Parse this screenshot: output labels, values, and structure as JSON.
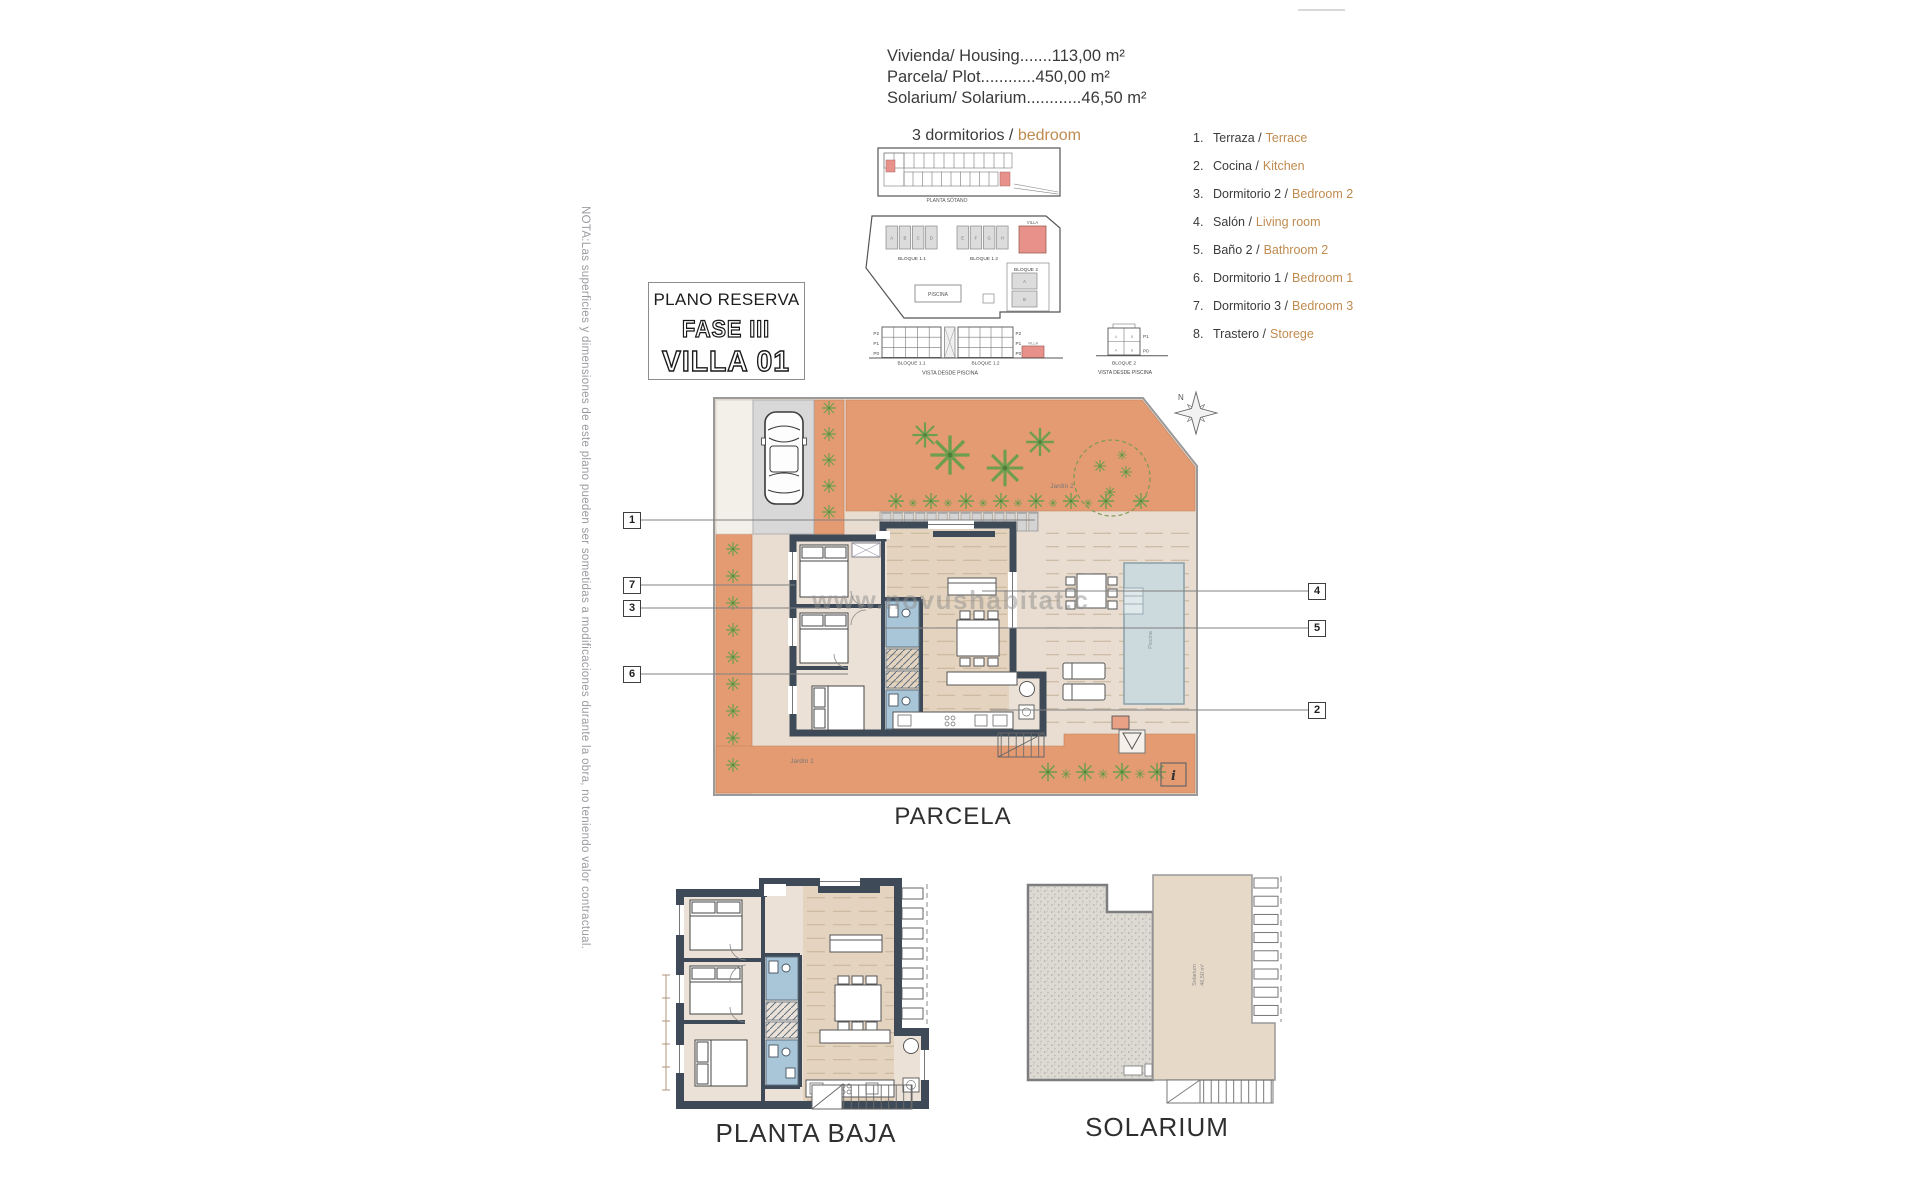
{
  "header": {
    "measurements": [
      "Vivienda/ Housing.......113,00 m²",
      "Parcela/ Plot............450,00 m²",
      "Solarium/ Solarium............46,50 m²"
    ],
    "bedrooms_es": "3 dormitorios /",
    "bedrooms_en": "bedroom"
  },
  "title_box": {
    "line1": "PLANO RESERVA",
    "line2": "FASE III",
    "line3": "VILLA 01"
  },
  "legend": {
    "items": [
      {
        "num": "1.",
        "es": "Terraza /",
        "en": "Terrace"
      },
      {
        "num": "2.",
        "es": "Cocina /",
        "en": "Kitchen"
      },
      {
        "num": "3.",
        "es": "Dormitorio 2 /",
        "en": "Bedroom 2"
      },
      {
        "num": "4.",
        "es": "Salón /",
        "en": "Living room"
      },
      {
        "num": "5.",
        "es": "Baño 2 /",
        "en": "Bathroom 2"
      },
      {
        "num": "6.",
        "es": "Dormitorio 1 /",
        "en": "Bedroom 1"
      },
      {
        "num": "7.",
        "es": "Dormitorio 3 /",
        "en": "Bedroom 3"
      },
      {
        "num": "8.",
        "es": "Trastero /",
        "en": "Storege"
      }
    ]
  },
  "note_vertical": "NOTA:Las superficies y dimensiones de este plano pueden ser sometidas a modificaciones durante la obra, no teniendo valor contractual.",
  "watermark": "www.novushabitat.c",
  "site_plans": {
    "sotano_label": "PLANTA SÓTANO",
    "bloque11": "BLOQUE 1.1",
    "bloque12": "BLOQUE 1.2",
    "bloque2": "BLOQUE 2",
    "piscina": "PISCINA",
    "villa": "VILLA",
    "vista": "VISTA DESDE PISCINA",
    "p2": "P2",
    "p1": "P1",
    "p0": "P0",
    "unit_letters_1": [
      "A",
      "B",
      "C",
      "D"
    ],
    "unit_letters_2": [
      "E",
      "F",
      "G",
      "H"
    ],
    "unit_letters_b2": [
      "A",
      "B"
    ]
  },
  "parcela": {
    "caption": "PARCELA",
    "jardin1": "Jardín 1",
    "jardin2": "Jardín 2",
    "info": "i",
    "north": "N",
    "pool_label": "Piscina"
  },
  "planta_baja": {
    "caption": "PLANTA BAJA"
  },
  "solarium": {
    "caption": "SOLARIUM",
    "label": "Solarium",
    "area": "46,50 m²"
  },
  "callouts": {
    "c1": "1",
    "c2": "2",
    "c3": "3",
    "c4": "4",
    "c5": "5",
    "c6": "6",
    "c7": "7"
  },
  "colors": {
    "accent_orange": "#c08b4f",
    "terrace_orange": "#e59b72",
    "wall_dark": "#3e4a57",
    "bath_blue": "#a9c6d9",
    "pool_blue": "#ccd9dd",
    "highlight_red": "#e8918a",
    "driveway_gray": "#d8d8d8",
    "plant_green": "#6f9e4f",
    "note_gray": "#9b9ba1"
  }
}
